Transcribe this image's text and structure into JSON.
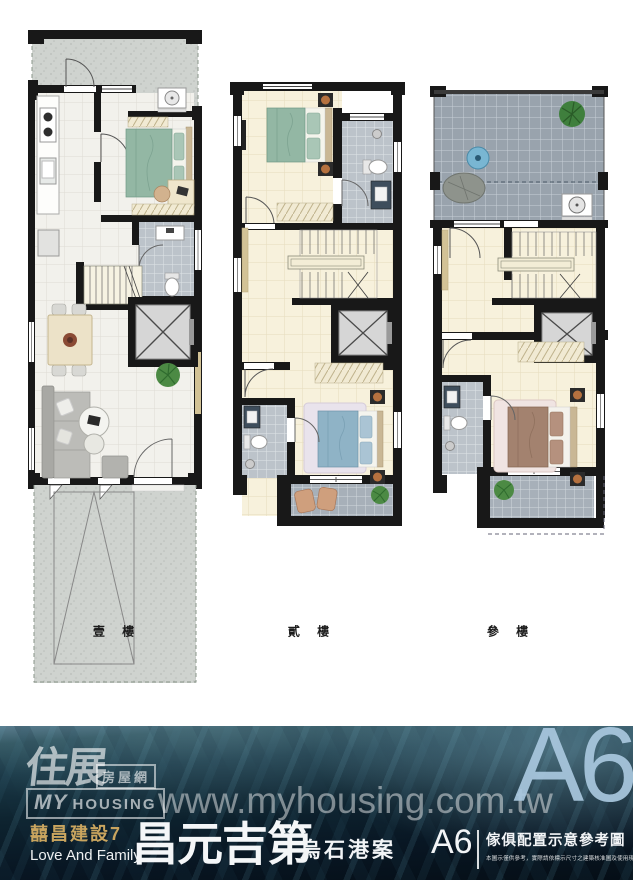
{
  "floors": [
    {
      "label": "壹 樓"
    },
    {
      "label": "貳 樓"
    },
    {
      "label": "參 樓"
    }
  ],
  "footer": {
    "logo_calligraphy": "住展",
    "logo_site": "房屋網",
    "logo_my": "MY",
    "logo_housing": "HOUSING",
    "watermark": "www.myhousing.com.tw",
    "unit_watermark": "A6",
    "developer": "囍昌建設7",
    "developer_en": "Love And Family",
    "project_name": "昌元吉第",
    "case_name": "烏石港案",
    "unit_label": "A6",
    "plan_note_title": "傢俱配置示意參考圖",
    "plan_note_text": "本圖示僅供參考，實際請依標示尺寸之建築核准圖及使用現況為準。"
  },
  "colors": {
    "wall": "#181818",
    "cream_floor": "#f7f1dc",
    "marble_floor": "#f2f1ec",
    "bath_tile": "#bcc3ca",
    "terrace_tile": "#99a3ad",
    "gold_accent": "#c9a55f",
    "unit_blue": "#a9c8de",
    "water_dark": "#0d2230",
    "bed_green": "#93b7a4",
    "bed_blue": "#8fb3c6",
    "bed_brown": "#a3826f"
  }
}
